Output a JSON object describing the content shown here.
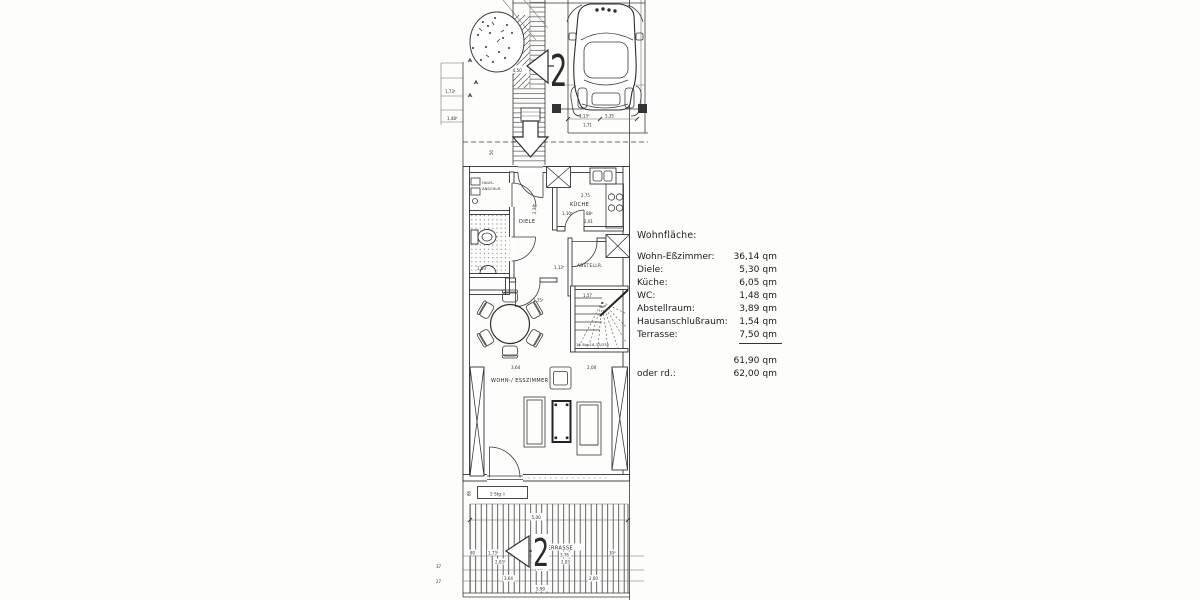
{
  "area_table": {
    "heading": "Wohnfläche:",
    "rows": [
      {
        "label": "Wohn-Eßzimmer:",
        "value": "36,14 qm"
      },
      {
        "label": "Diele:",
        "value": "5,30 qm"
      },
      {
        "label": "Küche:",
        "value": "6,05 qm"
      },
      {
        "label": "WC:",
        "value": "1,48 qm"
      },
      {
        "label": "Abstellraum:",
        "value": "3,89 qm"
      },
      {
        "label": "Hausanschlußraum:",
        "value": "1,54 qm"
      },
      {
        "label": "Terrasse:",
        "value": "7,50 qm"
      }
    ],
    "total_value": "61,90 qm",
    "rounded_label": "oder rd.:",
    "rounded_value": "62,00 qm"
  },
  "plan": {
    "rooms": {
      "hausanschluss_line1": "HAUS-",
      "hausanschluss_line2": "ANSCHLR.",
      "diele": "DIELE",
      "kueche": "KÜCHE",
      "abstellraum": "ABSTELLR.",
      "wohn_esszimmer": "WOHN-/ ESSZIMMER",
      "terrasse": "TERRASSE"
    },
    "markers": {
      "house_number_top": "2",
      "house_number_terrace": "2",
      "stair_note": "16 Stg 18,33/250",
      "step_note": "2 Stg ⇧"
    },
    "dimensions": {
      "entry": "4,50",
      "entry_small": "50",
      "left_upper_1": "1,73⁵",
      "left_upper_2": "1,48⁵",
      "garage_1": "1,13⁵",
      "garage_2": "5,35",
      "garage_3": "1,71",
      "kitchen_width": "2,75",
      "kitchen_a": "1,10⁵",
      "kitchen_b": "88⁵",
      "kitchen_c": "2,01",
      "diele_height": "2,38⁵",
      "wc_width": "1,63",
      "hall_a": "1,12⁵",
      "stair_width": "1,57",
      "table_a": "1,75⁵",
      "living_a": "3,64",
      "living_b": "2,00",
      "living_height": "4,79",
      "step_height": "86",
      "terrace_top": "5,00",
      "terrace_r1a": "80",
      "terrace_r1b": "1,73⁵",
      "terrace_r1c": "3,76",
      "terrace_r1d": "30⁵",
      "terrace_r2a": "2,03⁵",
      "terrace_r2b": "2,03",
      "terrace_r3": "5,64",
      "terrace_r4a": "3,64",
      "terrace_r4b": "2,00",
      "terrace_total": "5,99",
      "edge_a": "37",
      "edge_b": "27"
    }
  }
}
